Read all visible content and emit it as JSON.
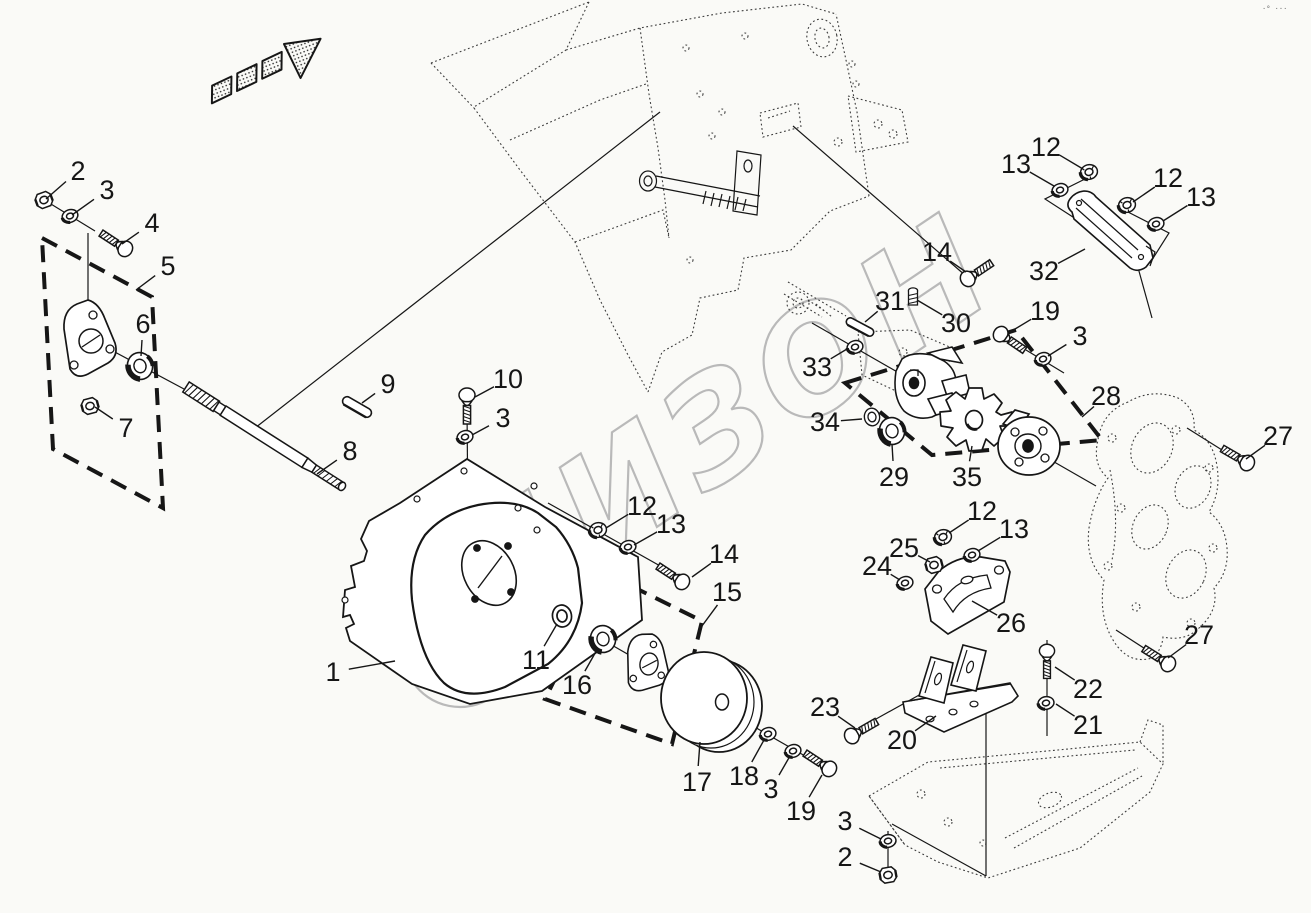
{
  "colors": {
    "background": "#fafaf7",
    "line": "#161616",
    "phantom": "#3c3c3c",
    "watermark": "#b9b9b9"
  },
  "watermark": {
    "text": "БИЗОН"
  },
  "corner_mark": "·° ···",
  "callouts": [
    {
      "n": "2",
      "tx": 78,
      "ty": 171,
      "lx": 46,
      "ly": 199
    },
    {
      "n": "3",
      "tx": 107,
      "ty": 190,
      "lx": 72,
      "ly": 215
    },
    {
      "n": "4",
      "tx": 152,
      "ty": 223,
      "lx": 122,
      "ly": 244
    },
    {
      "n": "5",
      "tx": 168,
      "ty": 266,
      "lx": 136,
      "ly": 290
    },
    {
      "n": "6",
      "tx": 143,
      "ty": 324,
      "lx": 141,
      "ly": 356
    },
    {
      "n": "7",
      "tx": 126,
      "ty": 428,
      "lx": 95,
      "ly": 407
    },
    {
      "n": "9",
      "tx": 388,
      "ty": 384,
      "lx": 362,
      "ly": 403
    },
    {
      "n": "8",
      "tx": 350,
      "ty": 451,
      "lx": 317,
      "ly": 474
    },
    {
      "n": "10",
      "tx": 508,
      "ty": 379,
      "lx": 475,
      "ly": 397
    },
    {
      "n": "3",
      "tx": 503,
      "ty": 418,
      "lx": 472,
      "ly": 435
    },
    {
      "n": "1",
      "tx": 333,
      "ty": 672,
      "lx": 395,
      "ly": 661
    },
    {
      "n": "12",
      "tx": 642,
      "ty": 506,
      "lx": 606,
      "ly": 528
    },
    {
      "n": "13",
      "tx": 671,
      "ty": 524,
      "lx": 634,
      "ly": 545
    },
    {
      "n": "11",
      "tx": 536,
      "ty": 660,
      "lx": 557,
      "ly": 624
    },
    {
      "n": "16",
      "tx": 577,
      "ty": 685,
      "lx": 598,
      "ly": 648
    },
    {
      "n": "14",
      "tx": 724,
      "ty": 554,
      "lx": 692,
      "ly": 577
    },
    {
      "n": "15",
      "tx": 727,
      "ty": 592,
      "lx": 699,
      "ly": 630
    },
    {
      "n": "17",
      "tx": 697,
      "ty": 782,
      "lx": 700,
      "ly": 742
    },
    {
      "n": "18",
      "tx": 744,
      "ty": 776,
      "lx": 764,
      "ly": 740
    },
    {
      "n": "3",
      "tx": 771,
      "ty": 789,
      "lx": 790,
      "ly": 756
    },
    {
      "n": "19",
      "tx": 801,
      "ty": 811,
      "lx": 822,
      "ly": 775
    },
    {
      "n": "12",
      "tx": 1046,
      "ty": 147,
      "lx": 1083,
      "ly": 169
    },
    {
      "n": "13",
      "tx": 1016,
      "ty": 164,
      "lx": 1054,
      "ly": 186
    },
    {
      "n": "12",
      "tx": 1168,
      "ty": 178,
      "lx": 1133,
      "ly": 202
    },
    {
      "n": "13",
      "tx": 1201,
      "ty": 197,
      "lx": 1163,
      "ly": 221
    },
    {
      "n": "14",
      "tx": 937,
      "ty": 252,
      "lx": 966,
      "ly": 272
    },
    {
      "n": "32",
      "tx": 1044,
      "ty": 271,
      "lx": 1085,
      "ly": 249
    },
    {
      "n": "31",
      "tx": 890,
      "ty": 301,
      "lx": 865,
      "ly": 322
    },
    {
      "n": "30",
      "tx": 956,
      "ty": 323,
      "lx": 917,
      "ly": 300
    },
    {
      "n": "33",
      "tx": 817,
      "ty": 367,
      "lx": 847,
      "ly": 349
    },
    {
      "n": "19",
      "tx": 1045,
      "ty": 311,
      "lx": 1010,
      "ly": 332
    },
    {
      "n": "3",
      "tx": 1080,
      "ty": 336,
      "lx": 1048,
      "ly": 356
    },
    {
      "n": "28",
      "tx": 1106,
      "ty": 396,
      "lx": 1082,
      "ly": 417
    },
    {
      "n": "34",
      "tx": 825,
      "ty": 422,
      "lx": 862,
      "ly": 419
    },
    {
      "n": "29",
      "tx": 894,
      "ty": 477,
      "lx": 892,
      "ly": 444
    },
    {
      "n": "35",
      "tx": 967,
      "ty": 477,
      "lx": 972,
      "ly": 446
    },
    {
      "n": "12",
      "tx": 982,
      "ty": 511,
      "lx": 949,
      "ly": 533
    },
    {
      "n": "13",
      "tx": 1014,
      "ty": 529,
      "lx": 978,
      "ly": 551
    },
    {
      "n": "25",
      "tx": 904,
      "ty": 548,
      "lx": 930,
      "ly": 562
    },
    {
      "n": "24",
      "tx": 877,
      "ty": 566,
      "lx": 900,
      "ly": 580
    },
    {
      "n": "26",
      "tx": 1011,
      "ty": 623,
      "lx": 972,
      "ly": 601
    },
    {
      "n": "27",
      "tx": 1278,
      "ty": 436,
      "lx": 1246,
      "ly": 459
    },
    {
      "n": "27",
      "tx": 1199,
      "ty": 635,
      "lx": 1168,
      "ly": 658
    },
    {
      "n": "22",
      "tx": 1088,
      "ty": 689,
      "lx": 1055,
      "ly": 667
    },
    {
      "n": "21",
      "tx": 1088,
      "ty": 725,
      "lx": 1056,
      "ly": 704
    },
    {
      "n": "23",
      "tx": 825,
      "ty": 707,
      "lx": 855,
      "ly": 728
    },
    {
      "n": "20",
      "tx": 902,
      "ty": 740,
      "lx": 936,
      "ly": 716
    },
    {
      "n": "3",
      "tx": 845,
      "ty": 821,
      "lx": 881,
      "ly": 839
    },
    {
      "n": "2",
      "tx": 845,
      "ty": 857,
      "lx": 881,
      "ly": 872
    }
  ]
}
